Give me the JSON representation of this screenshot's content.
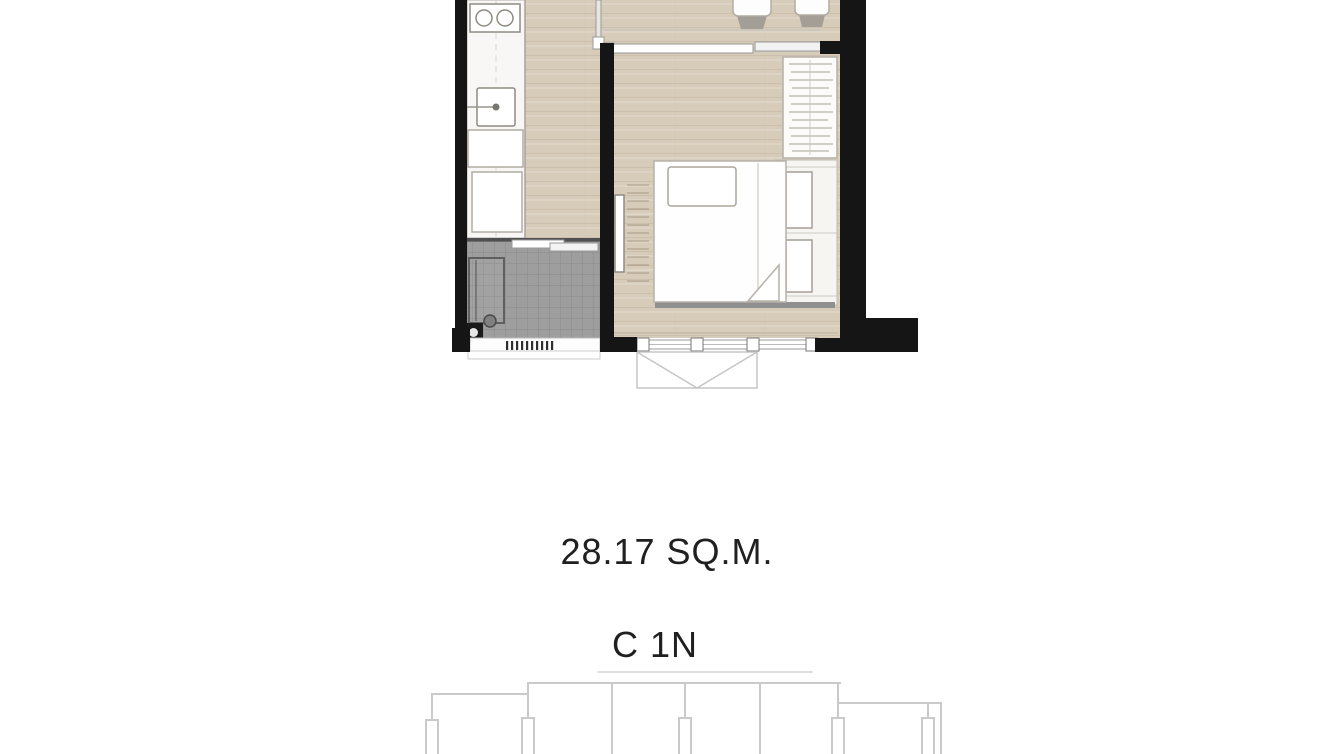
{
  "page": {
    "background_color": "#ffffff"
  },
  "floor_plan": {
    "type": "unit-floor-plan",
    "area_label": "28.17 SQ.M.",
    "unit_label": "C 1N",
    "rooms": [
      {
        "name": "kitchen",
        "features": [
          "counter",
          "two-burner-cooktop",
          "sink",
          "base-cabinets"
        ]
      },
      {
        "name": "bathroom",
        "features": [
          "shower-enclosure",
          "floor-drain",
          "sliding-door",
          "gray-tile-floor",
          "vent-louver"
        ]
      },
      {
        "name": "living-dining",
        "features": [
          "two-dining-chairs",
          "glass-partition",
          "sliding-door-track"
        ]
      },
      {
        "name": "bedroom",
        "features": [
          "bed",
          "pillow",
          "duvet-fold",
          "wardrobe-with-hanging-rail",
          "bedside-cabinets",
          "wall-mounted-tv",
          "window-band",
          "casement-opening-symbol"
        ]
      }
    ],
    "colors": {
      "wall": "#151515",
      "wood_floor": "#d7ccba",
      "wood_grain": "#c3b5a0",
      "tile_floor": "#9e9e9e",
      "furniture_fill": "#ffffff",
      "furniture_outline": "#a39e95",
      "shadow": "#8f8f8f",
      "key_plan_line": "#cacaca",
      "text": "#202020"
    }
  },
  "key_plan": {
    "name": "building-footprint-outline"
  }
}
